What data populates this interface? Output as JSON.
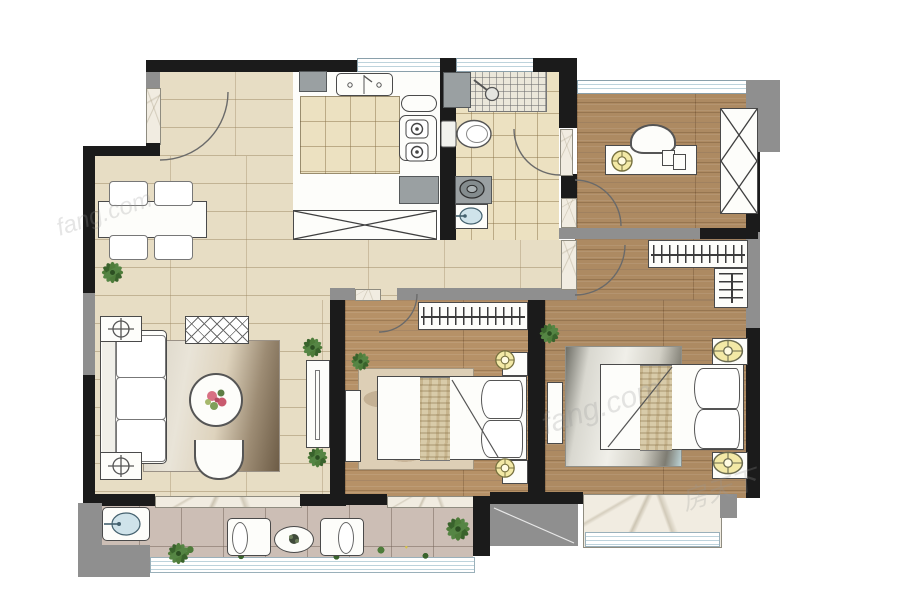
{
  "title": "apartment-floor-plan",
  "watermarks": {
    "wm1": "fang.com",
    "wm2": "房天下",
    "wm3": "fang.com"
  },
  "colors": {
    "wall": "#1b1b1b",
    "wallGray": "#8f8f8f",
    "hallFloor": "#e7ddc4",
    "woodFloor": "#ad8a62",
    "bathTile": "#ece1c1",
    "balconyTile": "#ccbeb5",
    "marble": "#f1ece1",
    "glass": "#bdd3dc",
    "plantGreen": "#4e7c3a",
    "plantGreenDark": "#39632c",
    "lampYellow": "#f3e9a6",
    "furnWhite": "#fdfdfa",
    "furnLine": "#4a4a4a",
    "applianceGray": "#9aa0a2",
    "basinBlue": "#cfe3ea"
  },
  "rooms": {
    "entry_dining": {
      "items": [
        "entry-door",
        "dining-table",
        "dining-chairs-4",
        "plant"
      ]
    },
    "kitchen": {
      "items": [
        "double-sink",
        "gas-stove-2-burner",
        "counter",
        "tray",
        "appliance",
        "x-storage-cabinet"
      ]
    },
    "bathroom": {
      "items": [
        "shower-area",
        "shower-head",
        "toilet",
        "washing-machine",
        "wash-basin",
        "cabinet"
      ]
    },
    "study": {
      "items": [
        "desk",
        "desk-chair",
        "desk-lamp",
        "books",
        "x-wardrobe",
        "window"
      ]
    },
    "living_room": {
      "items": [
        "sofa-3-seat",
        "side-table-2",
        "bench-lattice",
        "rug",
        "round-coffee-table",
        "flowers",
        "armchair",
        "tv-console",
        "plants"
      ]
    },
    "second_bedroom": {
      "items": [
        "bed",
        "pillows-2",
        "diagonal-throw",
        "nightstands-2",
        "lamps-2",
        "hanger-wardrobe",
        "rug",
        "tv-console",
        "plant",
        "window-sill"
      ]
    },
    "master_bedroom": {
      "items": [
        "bed",
        "pillows-2",
        "diagonal-throw",
        "nightstands-2",
        "lamps-2",
        "l-walk-in-closet",
        "rug",
        "tv-console",
        "plant",
        "bay-window"
      ]
    },
    "balcony": {
      "items": [
        "lounge-chair-2",
        "oval-table",
        "laundry-sink",
        "planting-strip",
        "glass-railing",
        "equipment-platform"
      ]
    }
  }
}
